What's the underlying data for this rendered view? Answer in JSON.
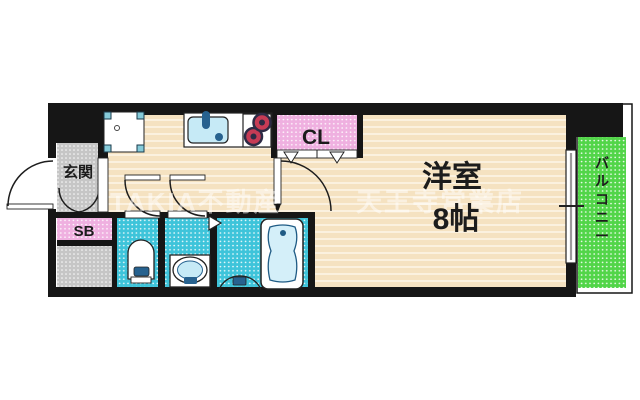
{
  "floorplan": {
    "labels": {
      "entrance": "玄関",
      "shoe_box": "SB",
      "closet": "CL",
      "main_room": "洋室",
      "main_room_size": "8帖",
      "balcony": "バルコニー"
    },
    "watermark": {
      "brand": "TAKIA不動産",
      "branch": "天王寺営業店"
    },
    "colors": {
      "wall": "#161616",
      "floor": "#F5E2C1",
      "floor_stripe": "#FBF1DF",
      "wet_room": "#3EC4DA",
      "closet_pink": "#EFB0E0",
      "balcony_green": "#52D549",
      "entrance_gray": "#C6C6C6",
      "fixture_blue": "#C6EAF6",
      "accent_blue": "#27628F",
      "burner_red": "#C63B55"
    }
  }
}
